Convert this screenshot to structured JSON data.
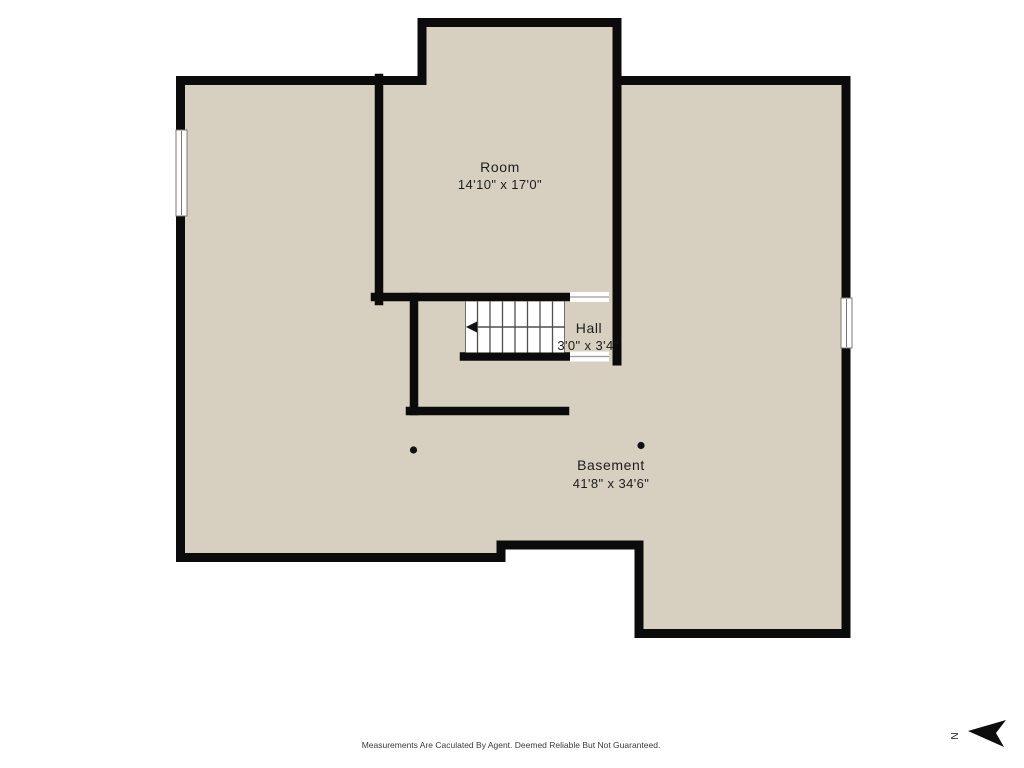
{
  "colors": {
    "floor": "#d7d0c0",
    "wall": "#0b0b0b",
    "stair_line": "#4f4f4f",
    "door_line": "#9c9c9c",
    "text": "#1c1c1c",
    "background": "#ffffff"
  },
  "rooms": {
    "room": {
      "name": "Room",
      "dimensions": "14'10\" x 17'0\""
    },
    "hall": {
      "name": "Hall",
      "dimensions": "3'0\" x 3'4\""
    },
    "basement": {
      "name": "Basement",
      "dimensions": "41'8\" x 34'6\""
    }
  },
  "stairs": {
    "treads": 8,
    "arrow_direction": "left"
  },
  "compass": {
    "label": "N"
  },
  "footer": {
    "disclaimer": "Measurements Are Caculated By Agent. Deemed Reliable But Not Guaranteed."
  }
}
